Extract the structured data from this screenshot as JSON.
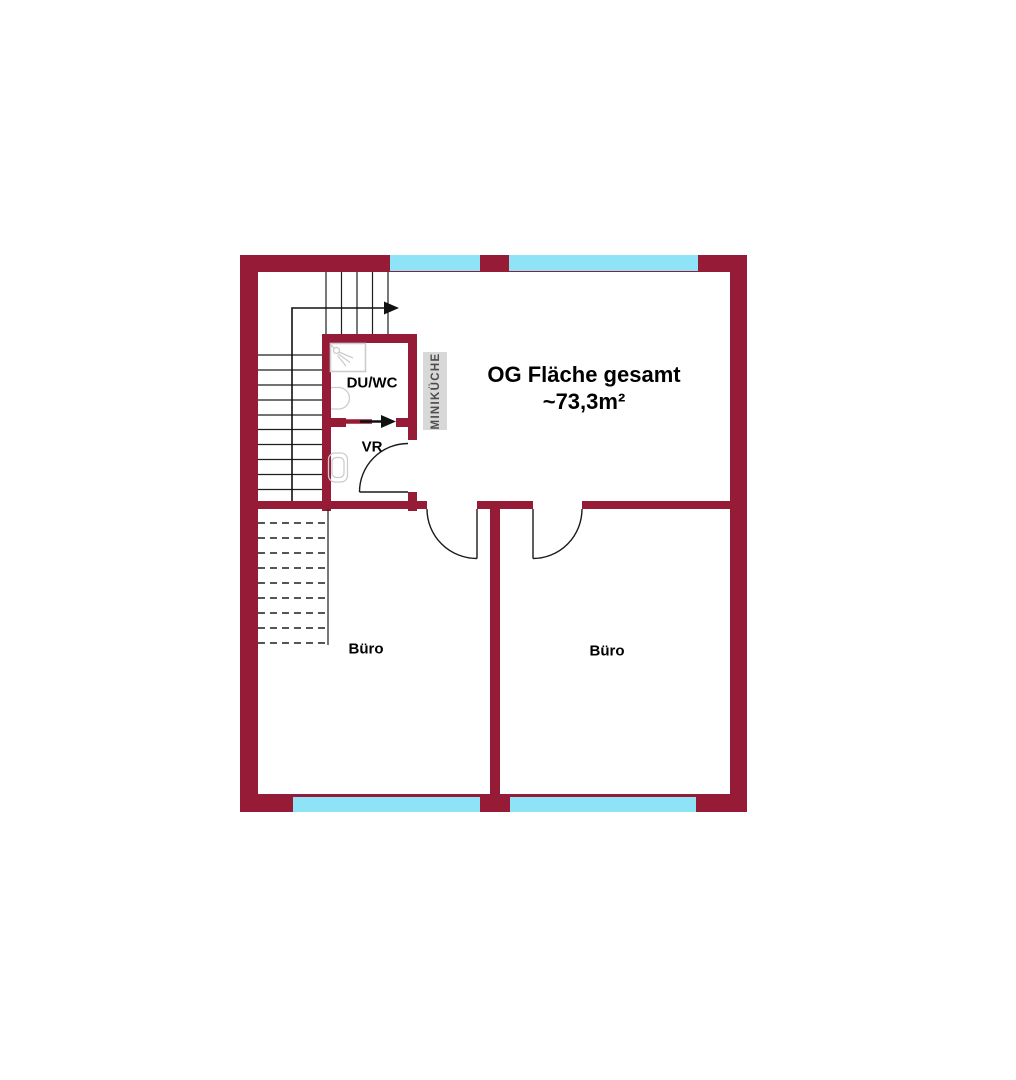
{
  "floorplan": {
    "title_line1": "OG Fläche gesamt",
    "title_line2": "~73,3m²",
    "rooms": {
      "shower_wc": "DU/WC",
      "vestibule": "VR",
      "office_left": "Büro",
      "office_right": "Büro",
      "kitchenette": "MINIKÜCHE"
    },
    "colors": {
      "wall": "#961b36",
      "window": "#8fe3f7",
      "stair_line": "#1f1f1f",
      "fixture": "#cccccc",
      "kitchenette_bg": "#d8d8d8",
      "kitchenette_text": "#4d4d4d"
    }
  }
}
